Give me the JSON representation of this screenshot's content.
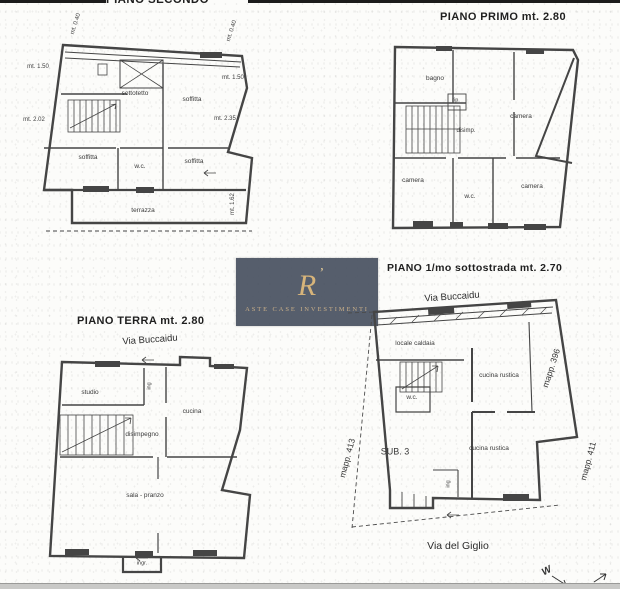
{
  "watermark": {
    "monogram": "R",
    "accent": "’",
    "caption": "ASTE CASE INVESTIMENTI"
  },
  "compass": {
    "west_label": "W"
  },
  "secondo": {
    "title": "PIANO SECONDO",
    "rooms": {
      "soffitta_tr": "soffitta",
      "sottotetto": "sottotetto",
      "soffitta_bl": "soffitta",
      "wc": "w.c.",
      "soffitta_br": "soffitta",
      "terrazza": "terrazza"
    },
    "measures": {
      "m040_left": "mt. 0.40",
      "m150_left": "mt. 1.50",
      "m202_left": "mt. 2.02",
      "m040_right": "mt. 0.40",
      "m150_right": "mt. 1.50",
      "m235_right": "mt. 2.35",
      "m162_right": "mt. 1.62"
    }
  },
  "primo": {
    "title": "PIANO PRIMO mt. 2.80",
    "rooms": {
      "bagno": "bagno",
      "camera_tr": "camera",
      "rip": "rip.",
      "disimp": "disimp.",
      "camera_bl": "camera",
      "wc": "w.c.",
      "camera_br": "camera"
    }
  },
  "terra": {
    "title": "PIANO TERRA mt. 2.80",
    "street": "Via Buccaidu",
    "rooms": {
      "studio": "studio",
      "ing": "ing",
      "cucina": "cucina",
      "disimpegno": "disimpegno",
      "sala_pranzo": "sala - pranzo",
      "ingr": "ingr."
    }
  },
  "sottostrada": {
    "title": "PIANO 1/mo sottostrada mt. 2.70",
    "street_top": "Via Buccaidu",
    "street_bottom": "Via del Giglio",
    "sub_label": "SUB. 3",
    "rooms": {
      "caldaia": "locale caldaia",
      "wc": "w.c.",
      "cucina_rustica_top": "cucina rustica",
      "cucina_rustica_bottom": "cucina rustica",
      "ing": "ing"
    },
    "mapp": {
      "left": "mapp. 413",
      "right_top": "mapp. 396",
      "right_bottom": "mapp. 411"
    }
  }
}
